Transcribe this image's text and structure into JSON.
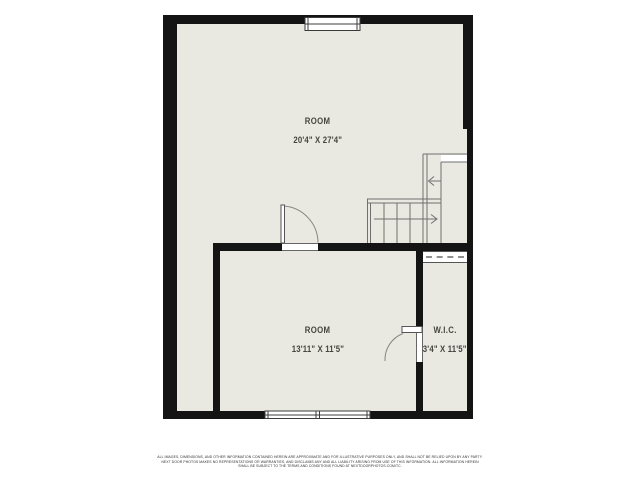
{
  "colors": {
    "background": "#ffffff",
    "floor_fill": "#e9e8e1",
    "wall": "#141414",
    "thin_line": "#707070",
    "text": "#454541"
  },
  "rooms": {
    "upper": {
      "name": "ROOM",
      "dimensions": "20'4\" X 27'4\""
    },
    "lower": {
      "name": "ROOM",
      "dimensions": "13'11\" X 11'5\""
    },
    "wic": {
      "name": "W.I.C.",
      "dimensions": "3'4\" X 11'5\""
    }
  },
  "disclaimer": {
    "line1": "ALL IMAGES, DIMENSIONS, AND OTHER INFORMATION CONTAINED HEREIN ARE APPROXIMATE AND FOR ILLUSTRATIVE PURPOSES ONLY, AND SHALL NOT BE RELIED UPON BY ANY PARTY.",
    "line2": "NEXT DOOR PHOTOS MAKES NO REPRESENTATIONS OR WARRANTIES, AND DISCLAIMS ANY AND ALL LIABILITY ARISING FROM USE OF THIS INFORMATION. ALL INFORMATION HEREIN",
    "line3": "SHALL BE SUBJECT TO THE TERMS AND CONDITIONS FOUND AT NEXTDOORPHOTOS.COM/TC."
  }
}
